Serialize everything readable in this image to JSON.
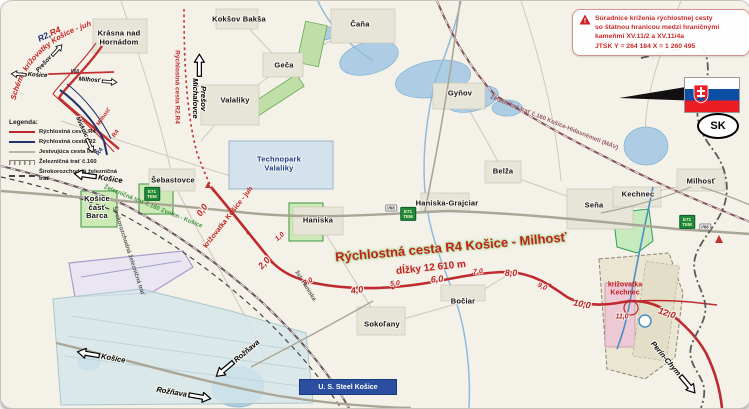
{
  "info_box": {
    "lines": [
      "Súradnice kríženia rýchlostnej cesty",
      "so štátnou hranicou medzi hraničnými",
      "kameňmi XV.11/2 a XV.11/4a",
      "JTSK  Y = 264 184   X = 1 260 495"
    ]
  },
  "legend": {
    "title": "Legenda:",
    "items": [
      {
        "type": "red",
        "label": "Rýchlostná cesta R4"
      },
      {
        "type": "navy",
        "label": "Rýchlostná cesta R2"
      },
      {
        "type": "gray",
        "label": "Jestvujúca cesta I/68"
      },
      {
        "type": "rail",
        "label": "Železničná trať č.160"
      },
      {
        "type": "dash",
        "label": "Širokorozchodná železničná trať"
      }
    ]
  },
  "schema": {
    "title_r2": "R2,",
    "title_r4": "R4",
    "arc_text": "Schéma križovatky Košice - juh",
    "i68": "I/68",
    "milhost_red": "Milhosť",
    "r4_red": "R4",
    "r4_blue": "R4"
  },
  "route": {
    "title": "Rýchlostná cesta R4 Košice - Milhosť",
    "length_label": "dĺžky 12 610 m",
    "junction_kosice_juh": "križovatka Košice - juh",
    "junction_kechnec": "križovatka\nKechnec",
    "planned_label": "Rýchlostná cesta R2.R4",
    "km_markers": [
      {
        "label": "0,0",
        "x": 201,
        "y": 209,
        "rot": -55
      },
      {
        "label": "1,0",
        "x": 279,
        "y": 236,
        "rot": -42,
        "small": true
      },
      {
        "label": "2,0",
        "x": 263,
        "y": 262,
        "rot": -48
      },
      {
        "label": "3,0",
        "x": 307,
        "y": 281,
        "rot": -25,
        "small": true
      },
      {
        "label": "4,0",
        "x": 356,
        "y": 289,
        "rot": -8
      },
      {
        "label": "5,0",
        "x": 394,
        "y": 283,
        "rot": -5,
        "small": true
      },
      {
        "label": "6,0",
        "x": 436,
        "y": 278,
        "rot": -5
      },
      {
        "label": "7,0",
        "x": 477,
        "y": 271,
        "rot": -5,
        "small": true
      },
      {
        "label": "8,0",
        "x": 510,
        "y": 272,
        "rot": 0
      },
      {
        "label": "9,0",
        "x": 541,
        "y": 286,
        "rot": 25,
        "small": true
      },
      {
        "label": "10,0",
        "x": 581,
        "y": 303,
        "rot": 10
      },
      {
        "label": "11,0",
        "x": 621,
        "y": 316,
        "rot": 0,
        "small": true
      },
      {
        "label": "12,0",
        "x": 666,
        "y": 312,
        "rot": 18
      }
    ]
  },
  "towns": [
    {
      "label": "Krásna nad\nHornádom",
      "x": 118,
      "y": 37
    },
    {
      "label": "Kokšov Bakša",
      "x": 238,
      "y": 19
    },
    {
      "label": "Čaňa",
      "x": 359,
      "y": 24
    },
    {
      "label": "Geča",
      "x": 283,
      "y": 65
    },
    {
      "label": "Valaliky",
      "x": 234,
      "y": 100
    },
    {
      "label": "Gyňov",
      "x": 459,
      "y": 93
    },
    {
      "label": "Šebastovce",
      "x": 172,
      "y": 180
    },
    {
      "label": "Technopark\nValaliky",
      "x": 278,
      "y": 163,
      "cls": "blue"
    },
    {
      "label": "Haniska",
      "x": 317,
      "y": 220
    },
    {
      "label": "Haniska-Grajciar",
      "x": 446,
      "y": 203
    },
    {
      "label": "Belža",
      "x": 502,
      "y": 171
    },
    {
      "label": "Seňa",
      "x": 593,
      "y": 205
    },
    {
      "label": "Kechnec",
      "x": 637,
      "y": 194
    },
    {
      "label": "Milhosť",
      "x": 700,
      "y": 181
    },
    {
      "label": "Bočiar",
      "x": 462,
      "y": 301
    },
    {
      "label": "Sokoľany",
      "x": 381,
      "y": 324
    },
    {
      "label": "Košice\nčasť\nBarca",
      "x": 96,
      "y": 207
    }
  ],
  "railway_labels": [
    {
      "label": "Železničná trať č.160 Košice-Hidasnémeti (MÁV)",
      "x": 553,
      "y": 122,
      "rot": 22,
      "cls": "maroon"
    },
    {
      "label": "Železničná trať č.160 Zvolen - Košice",
      "x": 152,
      "y": 206,
      "rot": 22,
      "cls": "green"
    },
    {
      "label": "Širokorozchodná železničná trať",
      "x": 127,
      "y": 250,
      "rot": 72,
      "cls": "dark"
    },
    {
      "label": "žst. Haniska",
      "x": 304,
      "y": 285,
      "rot": 58,
      "cls": "dark"
    }
  ],
  "signs": {
    "e71_label": "E71\nTEM",
    "e71_positions": [
      {
        "x": 151,
        "y": 193
      },
      {
        "x": 407,
        "y": 213
      },
      {
        "x": 686,
        "y": 221
      }
    ],
    "road_shield_label": "I/68",
    "shield_positions": [
      {
        "x": 390,
        "y": 207
      },
      {
        "x": 704,
        "y": 226
      }
    ]
  },
  "arrows": [
    {
      "label": "Košice",
      "x": 97,
      "y": 176,
      "rot": 8,
      "head": "left"
    },
    {
      "label": "Prešov\nMichalovce",
      "x": 198,
      "y": 85,
      "rot": 90,
      "head": "left"
    },
    {
      "label": "Košice",
      "x": 100,
      "y": 355,
      "rot": 10,
      "head": "left"
    },
    {
      "label": "Rožňava",
      "x": 236,
      "y": 358,
      "rot": -40,
      "head": "left"
    },
    {
      "label": "Rožňava",
      "x": 183,
      "y": 393,
      "rot": 10,
      "head": "right"
    },
    {
      "label": "Perín-Chym",
      "x": 673,
      "y": 367,
      "rot": 50,
      "head": "right"
    },
    {
      "label": "Košice",
      "x": 28,
      "y": 74,
      "rot": 4,
      "head": "left",
      "sm": true
    },
    {
      "label": "Milhosť",
      "x": 97,
      "y": 80,
      "rot": 4,
      "head": "right",
      "sm": true
    },
    {
      "label": "Prešov",
      "x": 49,
      "y": 57,
      "rot": -48,
      "head": "right",
      "sm": true
    },
    {
      "label": "Miskolc",
      "x": 84,
      "y": 134,
      "rot": 65,
      "head": "right",
      "sm": true
    }
  ],
  "flag": {
    "oval_code": "SK"
  },
  "ussteel": {
    "label": "U. S. Steel Košice"
  }
}
